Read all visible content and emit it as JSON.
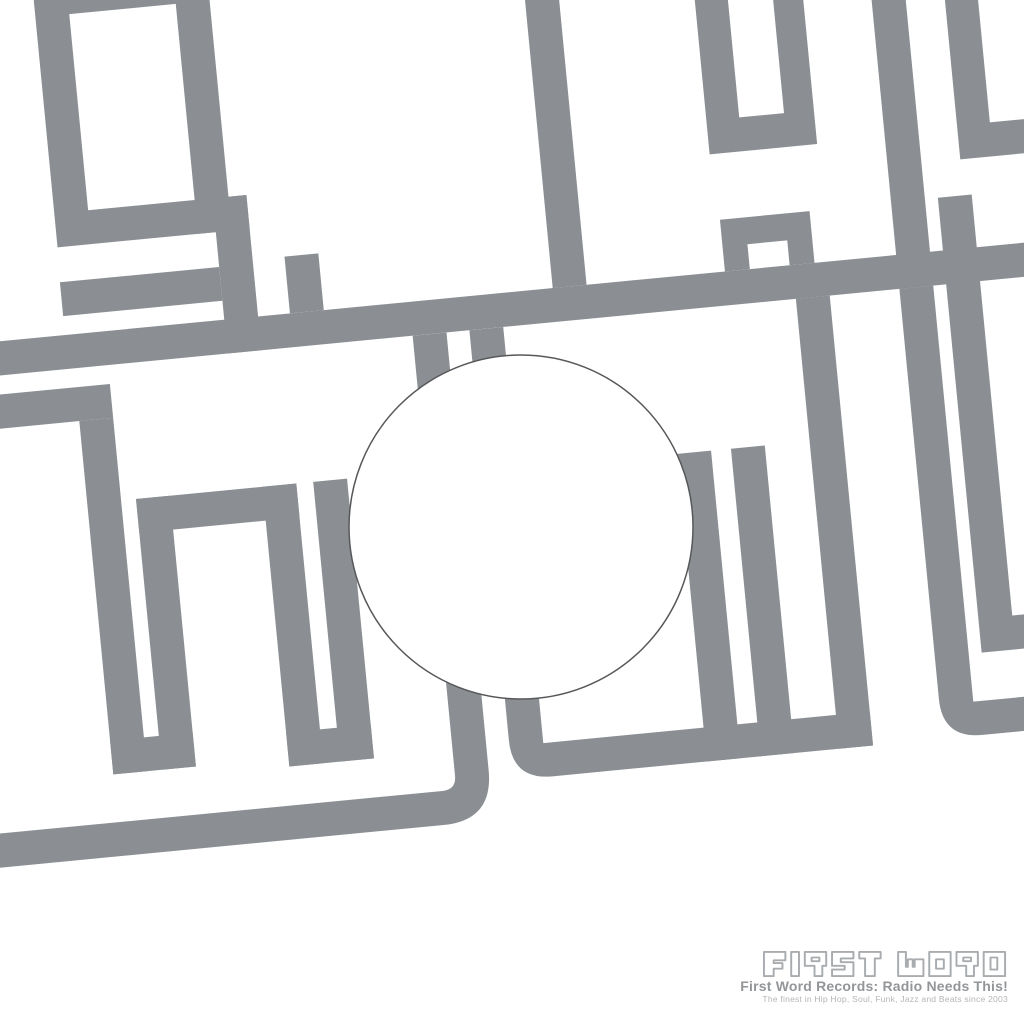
{
  "colors": {
    "background": "#ffffff",
    "letters": "#8b8f93",
    "hole_outline": "#57585a",
    "logo_outline": "#a9acaf",
    "tagline": "#939699",
    "subtagline": "#b3b6b8"
  },
  "logo": {
    "brand": "FIRST WORD",
    "brand_letters": [
      "F",
      "I",
      "R",
      "S",
      "T",
      "W",
      "O",
      "R",
      "D"
    ],
    "tagline": "First Word Records: Radio Needs This!",
    "subtagline": "The finest in Hip Hop, Soul, Funk, Jazz and Beats since 2003"
  }
}
